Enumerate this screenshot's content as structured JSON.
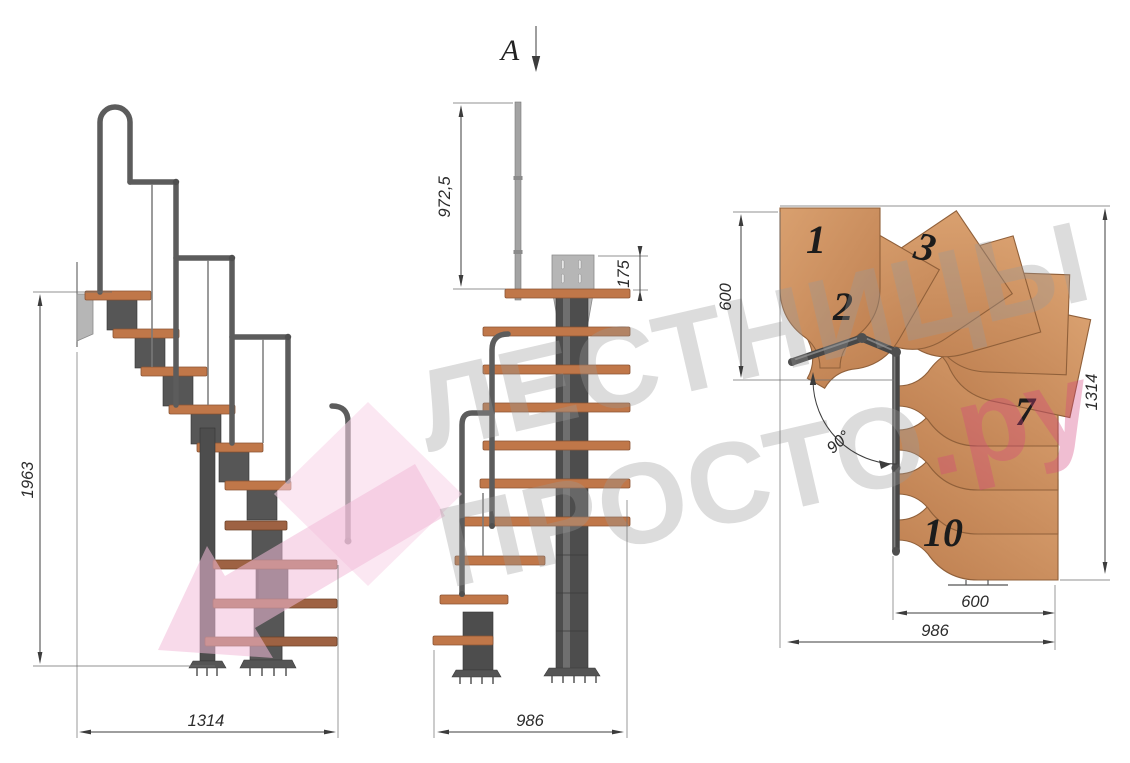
{
  "drawing": {
    "title": "Modular staircase technical drawing, three views",
    "section_label": "A",
    "step_numbers": [
      "1",
      "2",
      "3",
      "7",
      "10"
    ],
    "dimensions": {
      "side_height": "1963",
      "side_run": "1314",
      "front_rail_height": "972,5",
      "front_plate": "175",
      "front_width": "986",
      "plan_flight_width": "600",
      "plan_length": "1314",
      "plan_angle": "90°",
      "plan_tread_width": "600",
      "plan_total_width": "986"
    },
    "watermark": {
      "line1": "ЛЕСТНИЦЫ",
      "line2": "ПРОСТО",
      "suffix": ".ру"
    },
    "colors": {
      "wood": "#c98b5d",
      "wood_dark": "#9e6243",
      "metal": "#4d4d4d",
      "rail": "#5c5c5c",
      "dimension": "#3a3a3a",
      "watermark_gray": "#9a9a9a",
      "watermark_pink": "#d6447e",
      "watermark_arrow_pink": "#f3bcd9"
    }
  }
}
